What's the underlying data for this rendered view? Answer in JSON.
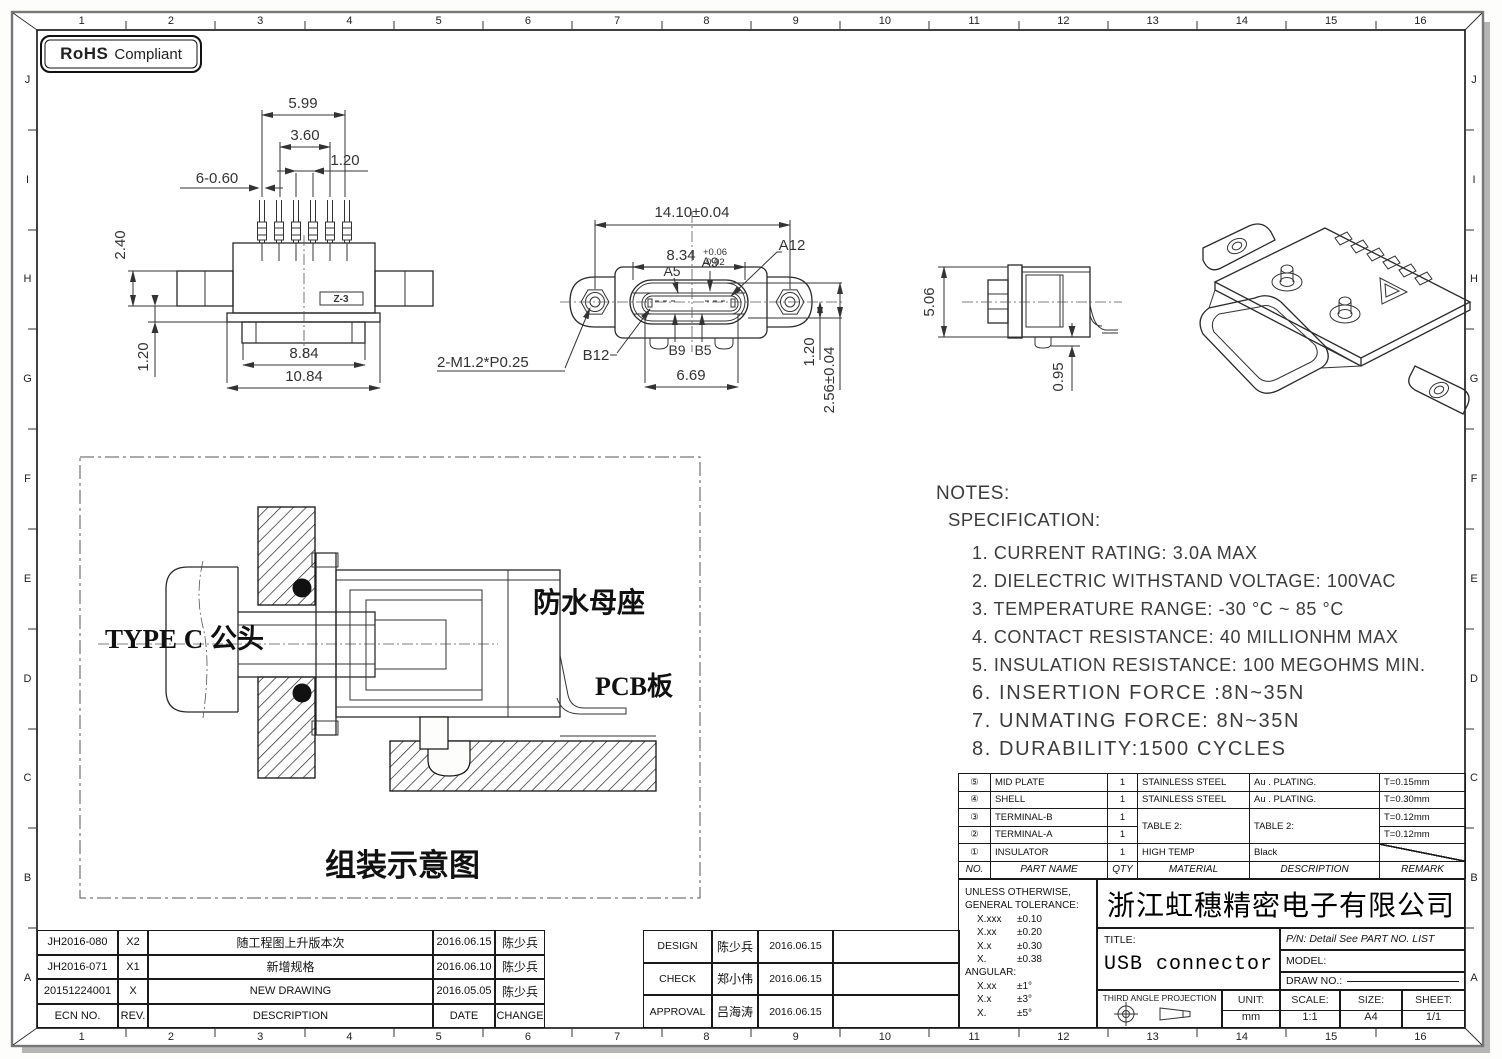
{
  "frame": {
    "cols": [
      "1",
      "2",
      "3",
      "4",
      "5",
      "6",
      "7",
      "8",
      "9",
      "10",
      "11",
      "12",
      "13",
      "14",
      "15",
      "16"
    ],
    "rows": [
      "J",
      "I",
      "H",
      "G",
      "F",
      "E",
      "D",
      "C",
      "B",
      "A"
    ]
  },
  "rohs": {
    "brand": "RoHS",
    "label": "Compliant"
  },
  "view_front": {
    "dim_top1": "5.99",
    "dim_top2": "3.60",
    "dim_top3": "1.20",
    "dim_pins": "6-0.60",
    "dim_left_top": "2.40",
    "dim_left_bottom": "1.20",
    "dim_bottom1": "8.84",
    "dim_bottom2": "10.84",
    "logo": "Z-3"
  },
  "view_plan": {
    "dim_width": "14.10±0.04",
    "dim_slot": "8.34",
    "tol_plus": "+0.06",
    "tol_minus": "-0.02",
    "dim_tongue": "6.69",
    "dim_v1": "1.20",
    "dim_v2": "2.56±0.04",
    "thread": "2-M1.2*P0.25",
    "labels": {
      "a5": "A5",
      "a9": "A9",
      "a12": "A12",
      "b12": "B12",
      "b9": "B9",
      "b5": "B5"
    }
  },
  "view_side": {
    "dim_height": "5.06",
    "dim_pin": "0.95"
  },
  "assembly": {
    "plug": "TYPE C 公头",
    "socket": "防水母座",
    "pcb": "PCB板",
    "caption": "组装示意图"
  },
  "notes": {
    "title": "NOTES:",
    "subtitle": "SPECIFICATION:",
    "items": [
      "1. CURRENT RATING: 3.0A MAX",
      "2. DIELECTRIC WITHSTAND VOLTAGE: 100VAC",
      "3. TEMPERATURE RANGE: -30 °C ~ 85 °C",
      "4. CONTACT RESISTANCE: 40 MILLIONHM MAX",
      "5. INSULATION RESISTANCE: 100 MEGOHMS MIN.",
      "6. INSERTION FORCE :8N~35N",
      "7. UNMATING FORCE: 8N~35N",
      "8. DURABILITY:1500 CYCLES"
    ]
  },
  "parts_table": {
    "headers": {
      "no": "NO.",
      "part": "PART NAME",
      "qty": "QTY",
      "material": "MATERIAL",
      "desc": "DESCRIPTION",
      "remark": "REMARK"
    },
    "rows": [
      {
        "no": "⑤",
        "part": "MID PLATE",
        "qty": "1",
        "material": "STAINLESS STEEL",
        "desc": "Au . PLATING.",
        "remark": "T=0.15mm"
      },
      {
        "no": "④",
        "part": "SHELL",
        "qty": "1",
        "material": "STAINLESS STEEL",
        "desc": "Au . PLATING.",
        "remark": "T=0.30mm"
      },
      {
        "no": "③",
        "part": "TERMINAL-B",
        "qty": "1",
        "material": "TABLE 2:",
        "desc": "TABLE 2:",
        "remark": "T=0.12mm"
      },
      {
        "no": "②",
        "part": "TERMINAL-A",
        "qty": "1",
        "material": "",
        "desc": "",
        "remark": "T=0.12mm"
      },
      {
        "no": "①",
        "part": "INSULATOR",
        "qty": "1",
        "material": "HIGH TEMP",
        "desc": "Black",
        "remark": ""
      }
    ]
  },
  "title_block": {
    "tolerance": {
      "heading1": "UNLESS OTHERWISE,",
      "heading2": "GENERAL TOLERANCE:",
      "rows": [
        {
          "k": "X.xxx",
          "v": "±0.10"
        },
        {
          "k": "X.xx",
          "v": "±0.20"
        },
        {
          "k": "X.x",
          "v": "±0.30"
        },
        {
          "k": "X.",
          "v": "±0.38"
        }
      ],
      "angular": "ANGULAR:",
      "angular_rows": [
        {
          "k": "X.xx",
          "v": "±1°"
        },
        {
          "k": "X.x",
          "v": "±3°"
        },
        {
          "k": "X.",
          "v": "±5°"
        }
      ]
    },
    "company": "浙江虹穗精密电子有限公司",
    "title_label": "TITLE:",
    "title_value": "USB connector",
    "pn": "P/N: Detail See PART NO. LIST",
    "model": "MODEL:",
    "draw_no": "DRAW NO.:",
    "projection": "THIRD ANGLE PROJECTION",
    "unit_label": "UNIT:",
    "unit_value": "mm",
    "scale_label": "SCALE:",
    "scale_value": "1:1",
    "size_label": "SIZE:",
    "size_value": "A4",
    "sheet_label": "SHEET:",
    "sheet_value": "1/1"
  },
  "revision_table": {
    "headers": {
      "ecn": "ECN NO.",
      "rev": "REV.",
      "desc": "DESCRIPTION",
      "date": "DATE",
      "change": "CHANGE"
    },
    "rows": [
      {
        "ecn": "JH2016-080",
        "rev": "X2",
        "desc": "随工程图上升版本次",
        "date": "2016.06.15",
        "change": "陈少兵"
      },
      {
        "ecn": "JH2016-071",
        "rev": "X1",
        "desc": "新增规格",
        "date": "2016.06.10",
        "change": "陈少兵"
      },
      {
        "ecn": "20151224001",
        "rev": "X",
        "desc": "NEW DRAWING",
        "date": "2016.05.05",
        "change": "陈少兵"
      }
    ]
  },
  "approval_table": {
    "rows": [
      {
        "role": "DESIGN",
        "name": "陈少兵",
        "date": "2016.06.15"
      },
      {
        "role": "CHECK",
        "name": "郑小伟",
        "date": "2016.06.15"
      },
      {
        "role": "APPROVAL",
        "name": "吕海涛",
        "date": "2016.06.15"
      }
    ]
  }
}
